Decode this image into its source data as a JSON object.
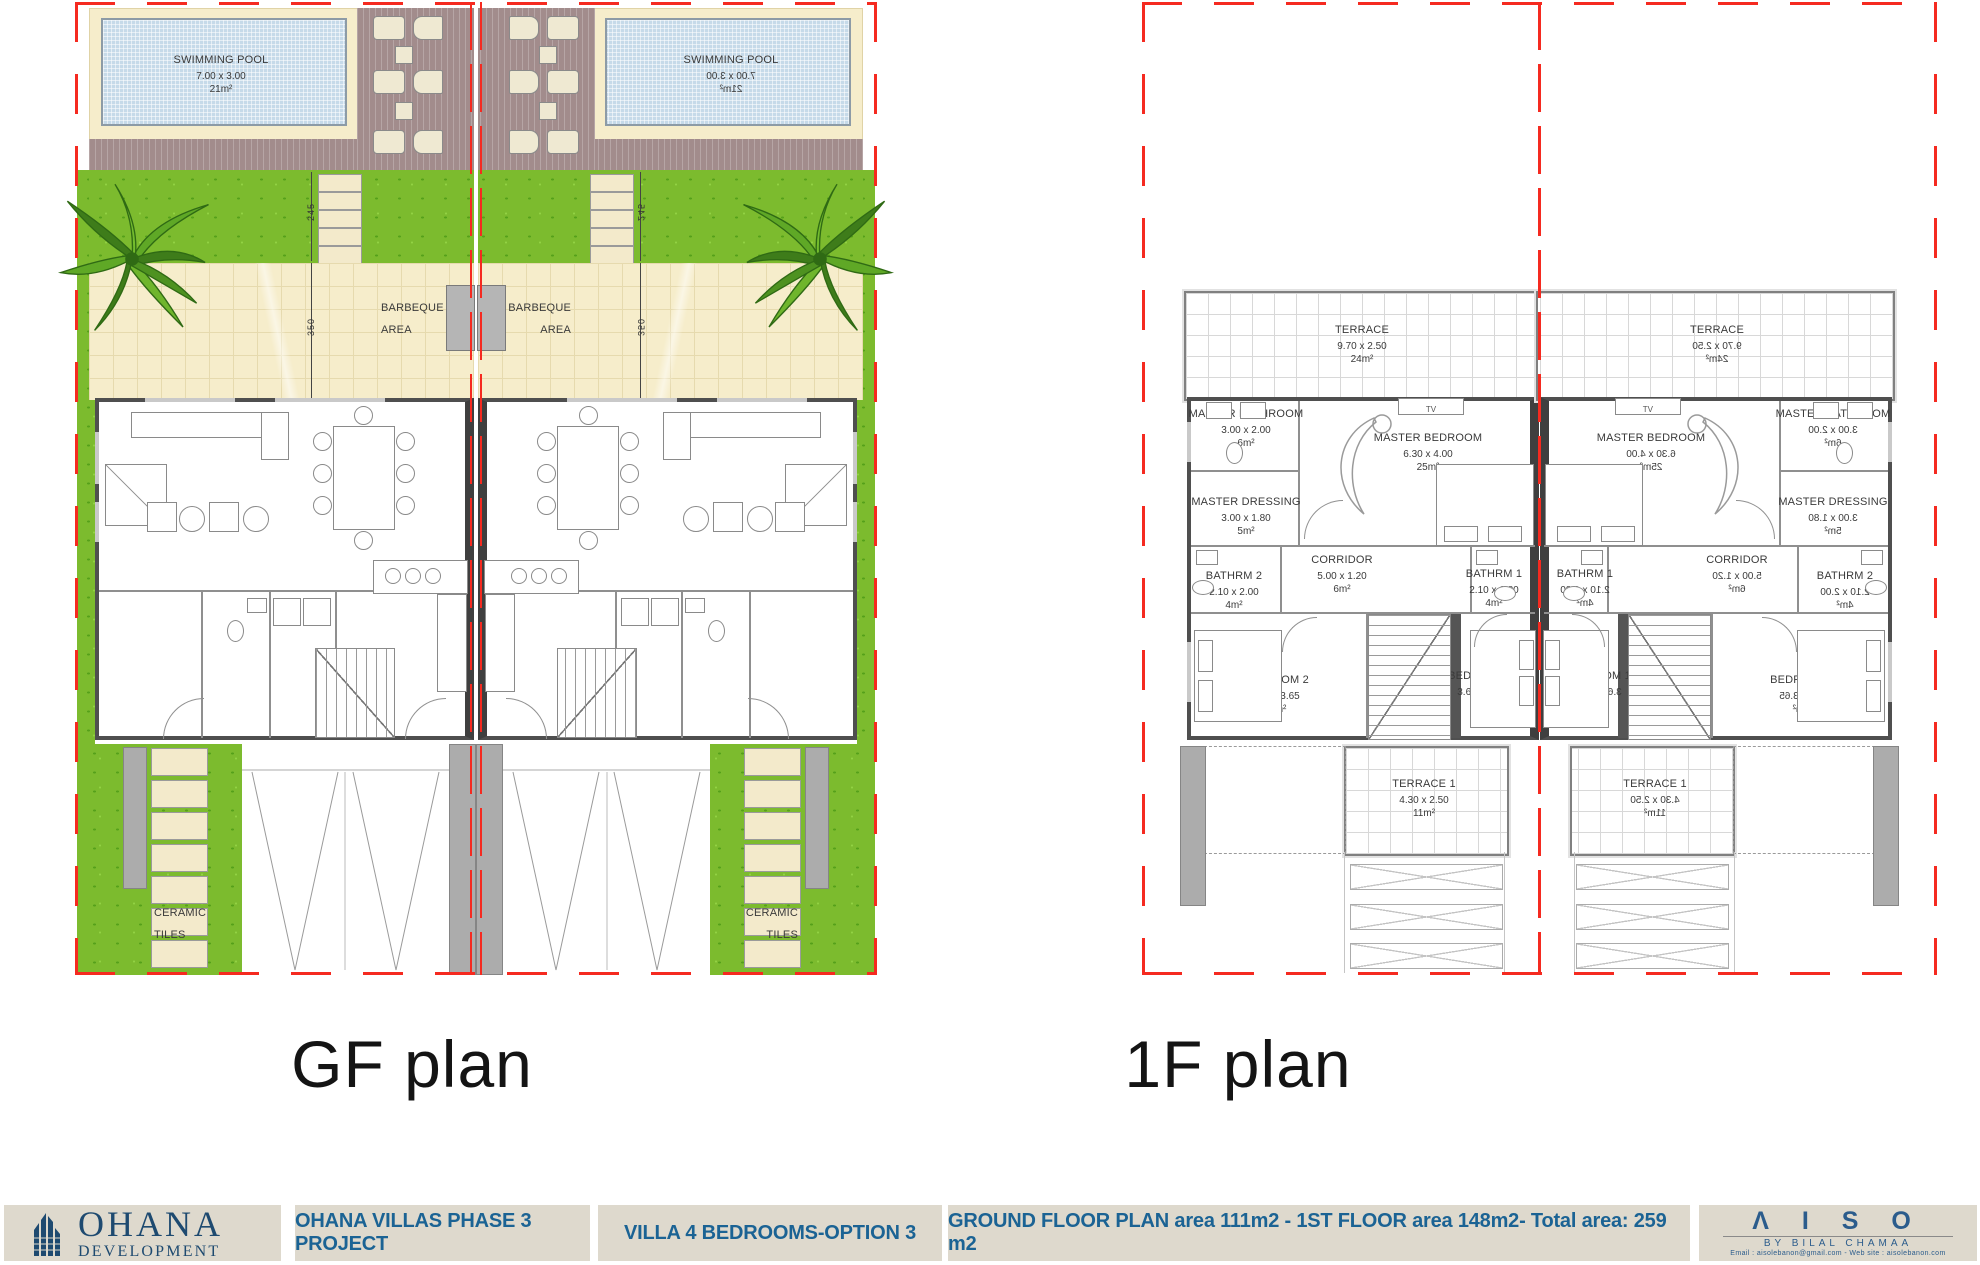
{
  "colors": {
    "plot_boundary_red": "#F52A20",
    "grass_green": "#7CBB2E",
    "patio_cream": "#F6EDCB",
    "pool_blue": "#C6DAE9",
    "deck_mauve": "#A28C8C",
    "wall_dark": "#4F4F4F",
    "footer_beige": "#DED9CD",
    "footer_text_blue": "#1B6394",
    "logo_navy": "#1E4A70"
  },
  "gf": {
    "title": "GF plan",
    "pool": {
      "name": "SWIMMING POOL",
      "dim": "7.00 x 3.00",
      "area": "21m²"
    },
    "barbeque": {
      "line1": "BARBEQUE",
      "line2": "AREA"
    },
    "living": {
      "name": "LIVING & DINING ROOM",
      "dim": "9.40 x 5.30",
      "area": "50m²"
    },
    "entrance": {
      "name": "ENTRANCE",
      "dim": "2.05 x 4.55",
      "area": "9m²"
    },
    "powder": {
      "name": "POWDER RM",
      "dim": "1.45 x 3.05",
      "area": "4m²"
    },
    "laundry": {
      "name": "LAUNDRY",
      "dim": "1.20 x 2.15",
      "area": "3m²"
    },
    "kitchen": {
      "name": "KITCHEN",
      "dim": "3.60 x 4.55",
      "area": "16m²"
    },
    "ceramic": {
      "line1": "CERAMIC",
      "line2": "TILES"
    },
    "dims": {
      "steps": "245",
      "patio": "350"
    }
  },
  "ff": {
    "title": "1F plan",
    "terrace": {
      "name": "TERRACE",
      "dim": "9.70 x 2.50",
      "area": "24m²"
    },
    "master_bathroom": {
      "name": "MASTER BATHROOM",
      "dim": "3.00 x 2.00",
      "area": "6m²"
    },
    "master_bedroom": {
      "name": "MASTER BEDROOM",
      "dim": "6.30 x 4.00",
      "area": "25m²",
      "tv": "TV"
    },
    "master_dressing": {
      "name": "MASTER DRESSING",
      "dim": "3.00 x 1.80",
      "area": "5m²"
    },
    "corridor": {
      "name": "CORRIDOR",
      "dim": "5.00 x 1.20",
      "area": "6m²"
    },
    "bathrm2": {
      "name": "BATHRM 2",
      "dim": "2.10 x 2.00",
      "area": "4m²"
    },
    "bathrm1": {
      "name": "BATHRM 1",
      "dim": "2.10 x 1.80",
      "area": "4m²"
    },
    "bedroom2": {
      "name": "BEDROOM 2",
      "dim": "4.20 x 3.65",
      "area": "15m²"
    },
    "bedroom1": {
      "name": "BEDROOM 1",
      "dim": "3.60 x 3.85",
      "area": "14m²"
    },
    "terrace1": {
      "name": "TERRACE 1",
      "dim": "4.30 x 2.50",
      "area": "11m²"
    }
  },
  "footer": {
    "logo": {
      "name": "OHANA",
      "sub": "DEVELOPMENT"
    },
    "project": "OHANA VILLAS PHASE 3 PROJECT",
    "villa": "VILLA 4 BEDROOMS-OPTION 3",
    "areas": "GROUND FLOOR PLAN area 111m2 - 1ST FLOOR area 148m2- Total area: 259 m2",
    "aiso": {
      "brand": "Λ I S O",
      "by": "BY  BILAL  CHAMAA",
      "contact": "Email : aisolebanon@gmail.com -  Web site : aisolebanon.com"
    }
  }
}
